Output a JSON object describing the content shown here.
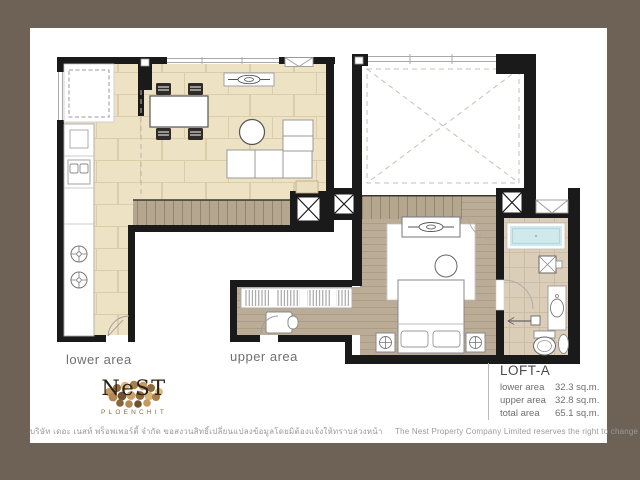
{
  "plan_labels": {
    "lower": "lower area",
    "upper": "upper area"
  },
  "logo": {
    "name": "NeST",
    "subtitle": "PLOENCHIT"
  },
  "unit_info": {
    "unit_name": "LOFT-A",
    "areas": [
      {
        "label": "lower area",
        "value": "32.3 sq.m."
      },
      {
        "label": "upper area",
        "value": "32.8 sq.m."
      },
      {
        "label": "total area",
        "value": "65.1 sq.m."
      }
    ]
  },
  "disclaimer": {
    "thai": "บริษัท เดอะ เนสท์ พร็อพเพอร์ตี้ จำกัด ขอสงวนสิทธิ์เปลี่ยนแปลงข้อมูลโดยมิต้องแจ้งให้ทราบล่วงหน้า",
    "english": "The Nest Property Company Limited reserves the right to change any information without prior notice"
  },
  "colors": {
    "frame": "#6e6156",
    "paper": "#ffffff",
    "wall": "#1a1a1a",
    "tile_floor": "#eee2c4",
    "wood_floor": "#bbac97",
    "stair": "#b5a690",
    "bath_tile": "#dbceb8",
    "bathtub": "#cfe9ec",
    "logo_gold": "#c59a5e"
  },
  "icons": {
    "void_label": "open-to-below-void",
    "shaft_label": "service-shaft"
  }
}
